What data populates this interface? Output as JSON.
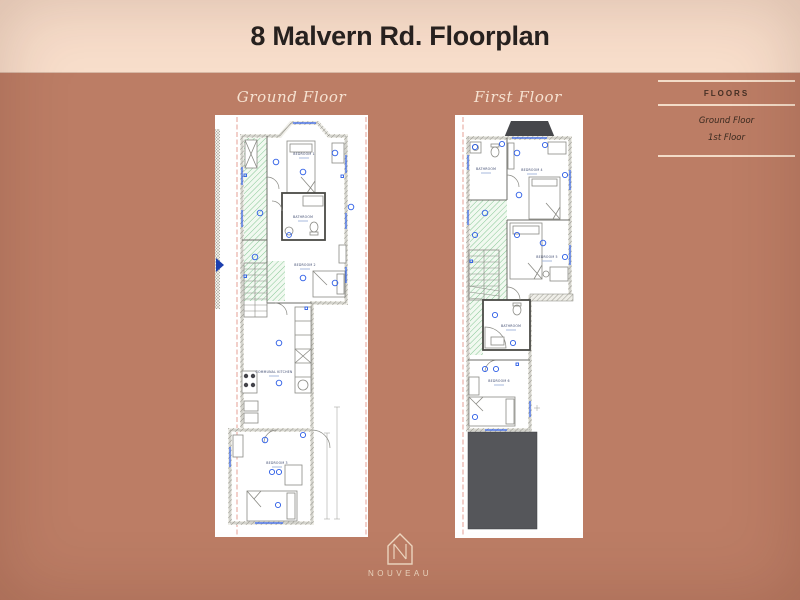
{
  "header": {
    "title": "8 Malvern Rd. Floorplan"
  },
  "floors": {
    "ground": {
      "label": "Ground Floor",
      "rooms": {
        "bedroom1": "BEDROOM 1",
        "bathroom": "BATHROOM",
        "bedroom2": "BEDROOM 2",
        "kitchen": "COMMUNAL KITCHEN",
        "bedroom3": "BEDROOM 3"
      }
    },
    "first": {
      "label": "First Floor",
      "rooms": {
        "bathroom_top": "BATHROOM",
        "bedroom4": "BEDROOM 4",
        "bedroom5": "BEDROOM 5",
        "bathroom_mid": "BATHROOM",
        "bedroom6": "BEDROOM 6"
      }
    }
  },
  "sidebar": {
    "heading": "FLOORS",
    "items": [
      {
        "label": "Ground Floor"
      },
      {
        "label": "1st Floor"
      }
    ]
  },
  "logo": {
    "brand": "NOUVEAU"
  },
  "colors": {
    "background": "#bc7d65",
    "banner": "#f8decb",
    "cream_text": "#f6e2d1",
    "plan_blue": "#2b5ce6",
    "corridor_green": "#86c795",
    "roof_gray": "#55565a",
    "boundary_red": "#d4604f"
  }
}
